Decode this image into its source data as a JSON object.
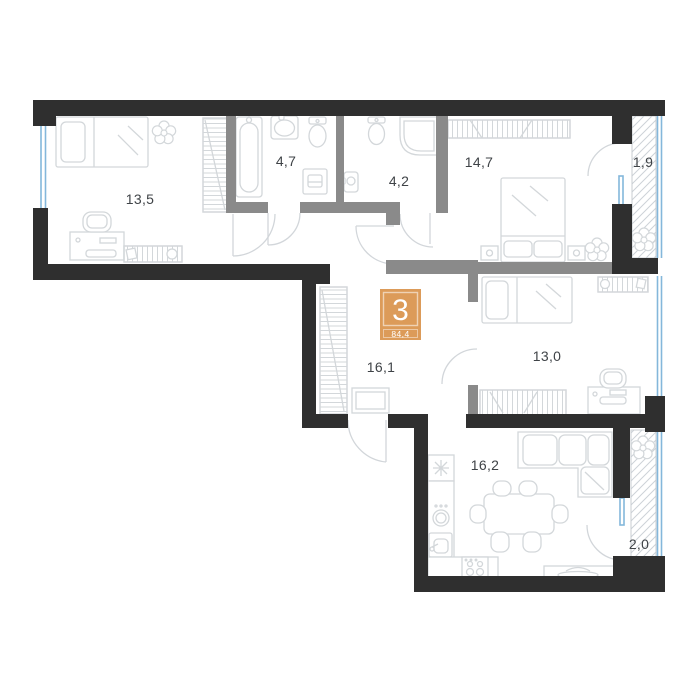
{
  "floor_plan": {
    "badge": {
      "rooms_count": "3",
      "total_area": "84,4",
      "color": "#DC9B59"
    },
    "room_areas": [
      {
        "id": "bedroom-left",
        "area": "13,5"
      },
      {
        "id": "bathroom-1",
        "area": "4,7"
      },
      {
        "id": "bathroom-2",
        "area": "4,2"
      },
      {
        "id": "bedroom-top-right",
        "area": "14,7"
      },
      {
        "id": "balcony-top",
        "area": "1,9"
      },
      {
        "id": "hallway",
        "area": "16,1"
      },
      {
        "id": "bedroom-right",
        "area": "13,0"
      },
      {
        "id": "kitchen-living-room",
        "area": "16,2"
      },
      {
        "id": "balcony-bottom",
        "area": "2,0"
      }
    ],
    "colors": {
      "exterior_wall": "#2f2f2f",
      "interior_wall": "#8a8a8a",
      "window_glazing": "#84b7db",
      "furniture_line": "#d3d7da",
      "balcony_hatch": "#cdd2d7",
      "label_text": "#3f4347",
      "badge_orange": "#DC9B59"
    }
  }
}
